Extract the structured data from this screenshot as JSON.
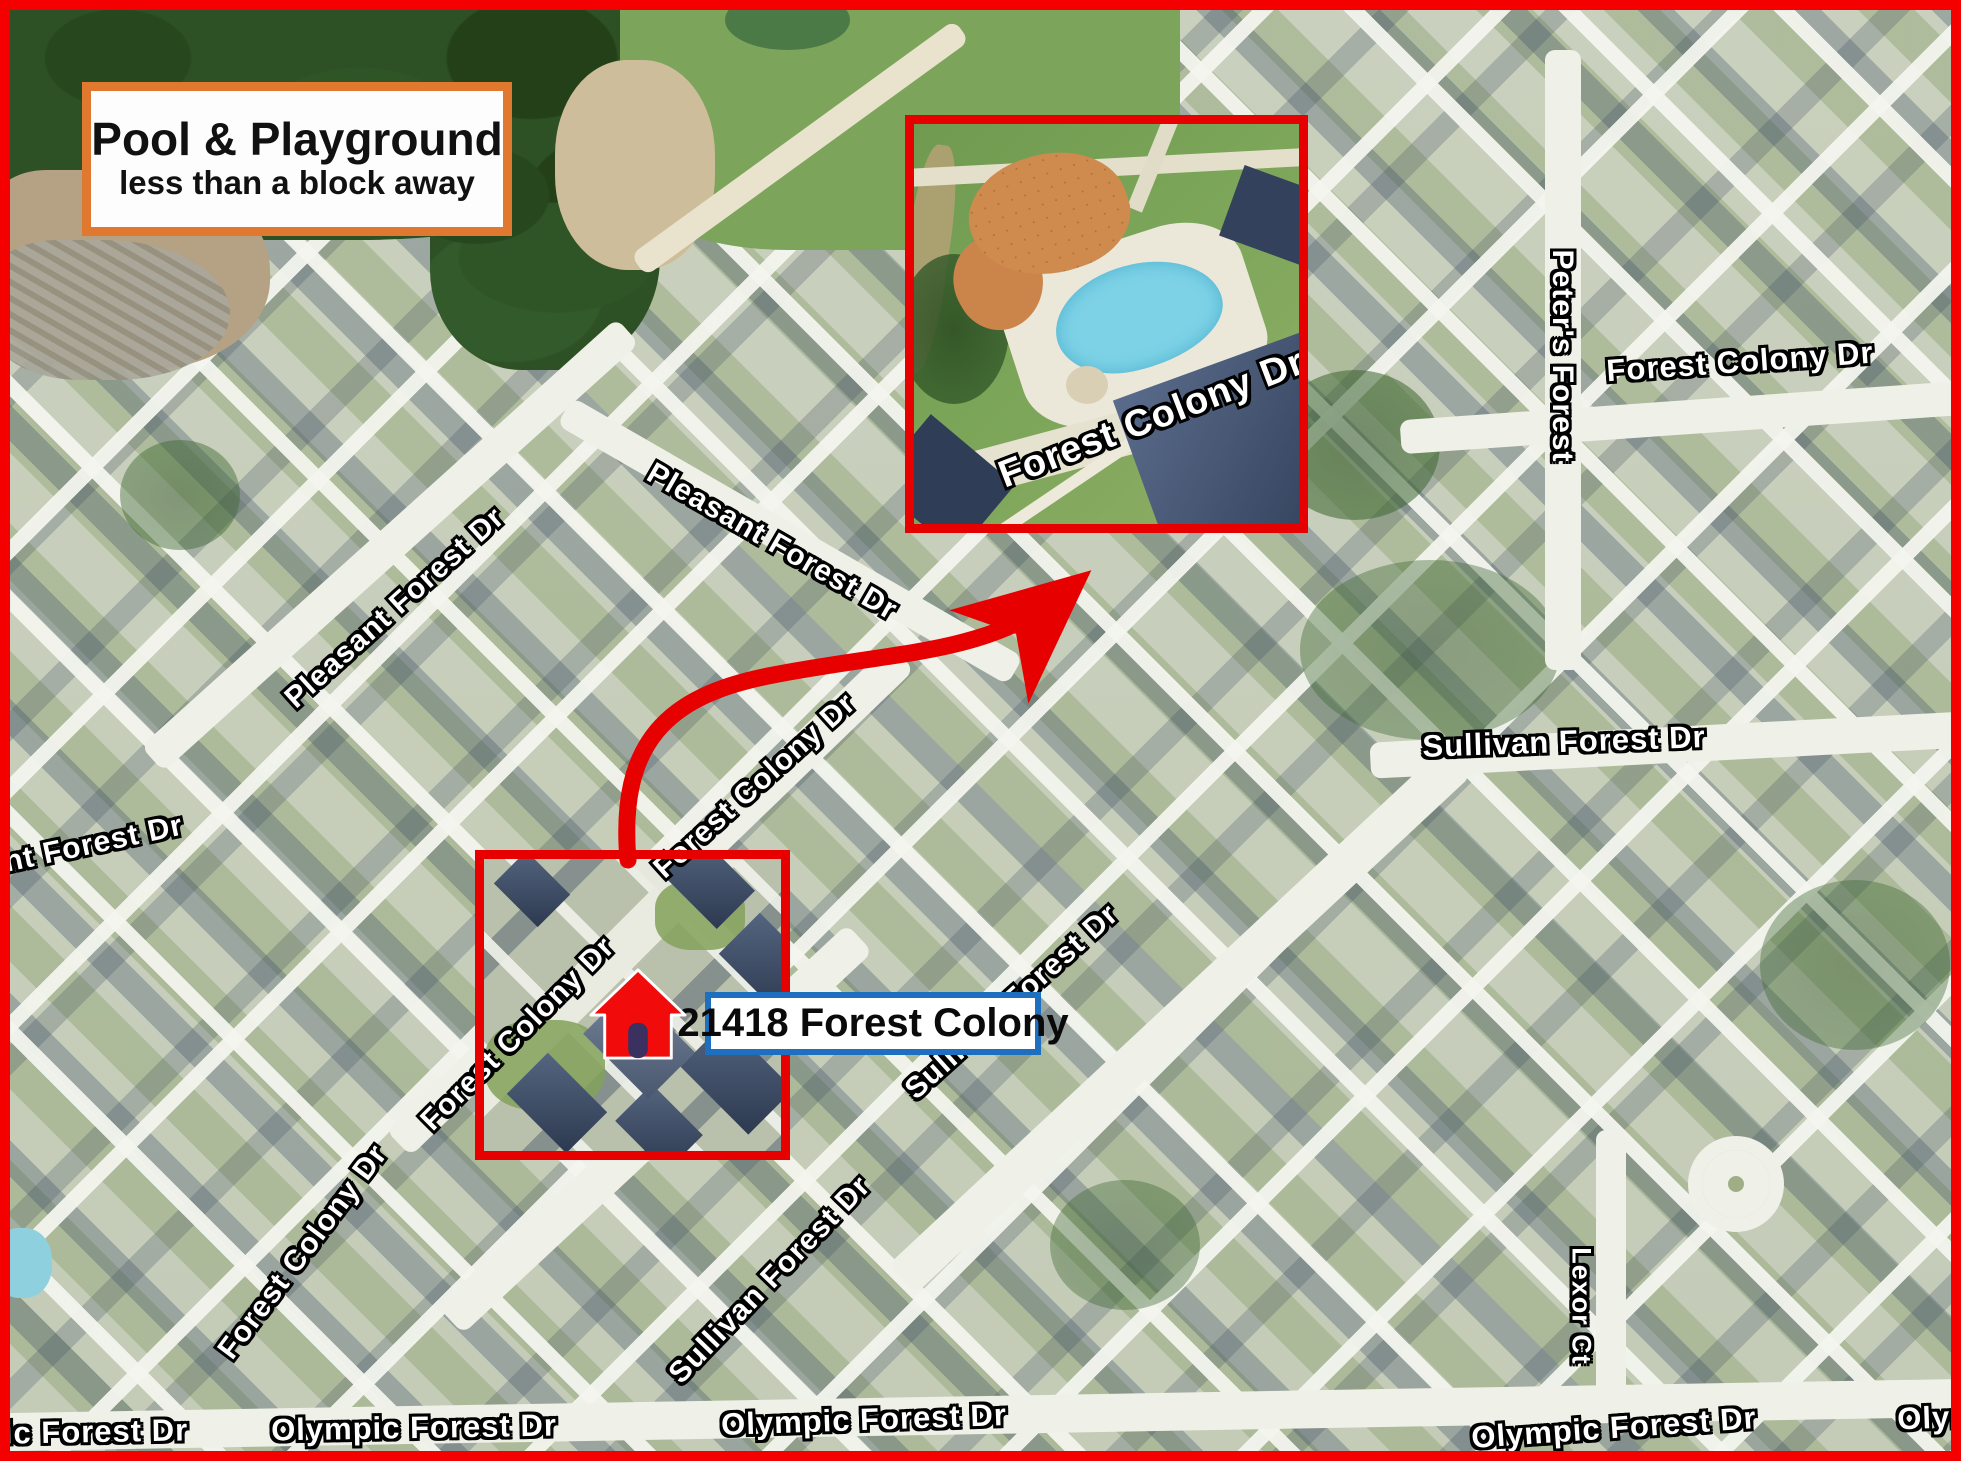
{
  "meta": {
    "description": "Aerial neighborhood map flyer highlighting home location and nearby pool & playground"
  },
  "colors": {
    "page_border": "#f50000",
    "annotation_red": "#e60000",
    "callout_orange": "#e0792f",
    "address_blue": "#1e6fbe",
    "pool_water": "#7ed2e6",
    "playground_sand": "#cf8a4e",
    "house_marker_red": "#f20b0b",
    "street_label_fill": "#ffffff",
    "street_label_outline": "#000000"
  },
  "callout": {
    "title": "Pool & Playground",
    "subtitle": "less than a block away"
  },
  "address_label": {
    "text": "21418 Forest Colony"
  },
  "inset": {
    "street_label": "Forest Colony Dr",
    "content": "aerial view of community pool, splash deck, playground and pavilion"
  },
  "house_marker": {
    "icon": "house-icon",
    "location_street": "Forest Colony Dr"
  },
  "street_labels": [
    {
      "text": "Pleasant Forest Dr",
      "x": 395,
      "y": 608,
      "rot": -42,
      "size": 30
    },
    {
      "text": "Pleasant Forest Dr",
      "x": 772,
      "y": 542,
      "rot": 30,
      "size": 30
    },
    {
      "text": "Forest Colony Dr",
      "x": 755,
      "y": 786,
      "rot": -42,
      "size": 30
    },
    {
      "text": "Forest Colony Dr",
      "x": 518,
      "y": 1034,
      "rot": -45,
      "size": 30
    },
    {
      "text": "Forest Colony Dr",
      "x": 303,
      "y": 1252,
      "rot": -53,
      "size": 30
    },
    {
      "text": "ant Forest Dr",
      "x": 85,
      "y": 846,
      "rot": -12,
      "size": 30
    },
    {
      "text": "Sullivan Forest Dr",
      "x": 1564,
      "y": 742,
      "rot": -2,
      "size": 31
    },
    {
      "text": "Sullivan Forest Dr",
      "x": 1012,
      "y": 1002,
      "rot": -42,
      "size": 30
    },
    {
      "text": "Sullivan Forest Dr",
      "x": 770,
      "y": 1280,
      "rot": -46,
      "size": 30
    },
    {
      "text": "Forest Colony Dr",
      "x": 1740,
      "y": 362,
      "rot": -4,
      "size": 31
    },
    {
      "text": "Olympic Forest Dr",
      "x": 414,
      "y": 1428,
      "rot": -1,
      "size": 31
    },
    {
      "text": "Olympic Forest Dr",
      "x": 864,
      "y": 1420,
      "rot": -2,
      "size": 31
    },
    {
      "text": "Olympic Forest Dr",
      "x": 1614,
      "y": 1428,
      "rot": -4,
      "size": 31
    },
    {
      "text": "Olym",
      "x": 1938,
      "y": 1418,
      "rot": -2,
      "size": 31
    },
    {
      "text": "ic Forest Dr",
      "x": 96,
      "y": 1432,
      "rot": -1,
      "size": 31
    },
    {
      "text": "Peter's Forest",
      "x": 1562,
      "y": 356,
      "rot": 90,
      "size": 30
    },
    {
      "text": "Lexor Ct",
      "x": 1581,
      "y": 1306,
      "rot": 90,
      "size": 27
    }
  ]
}
